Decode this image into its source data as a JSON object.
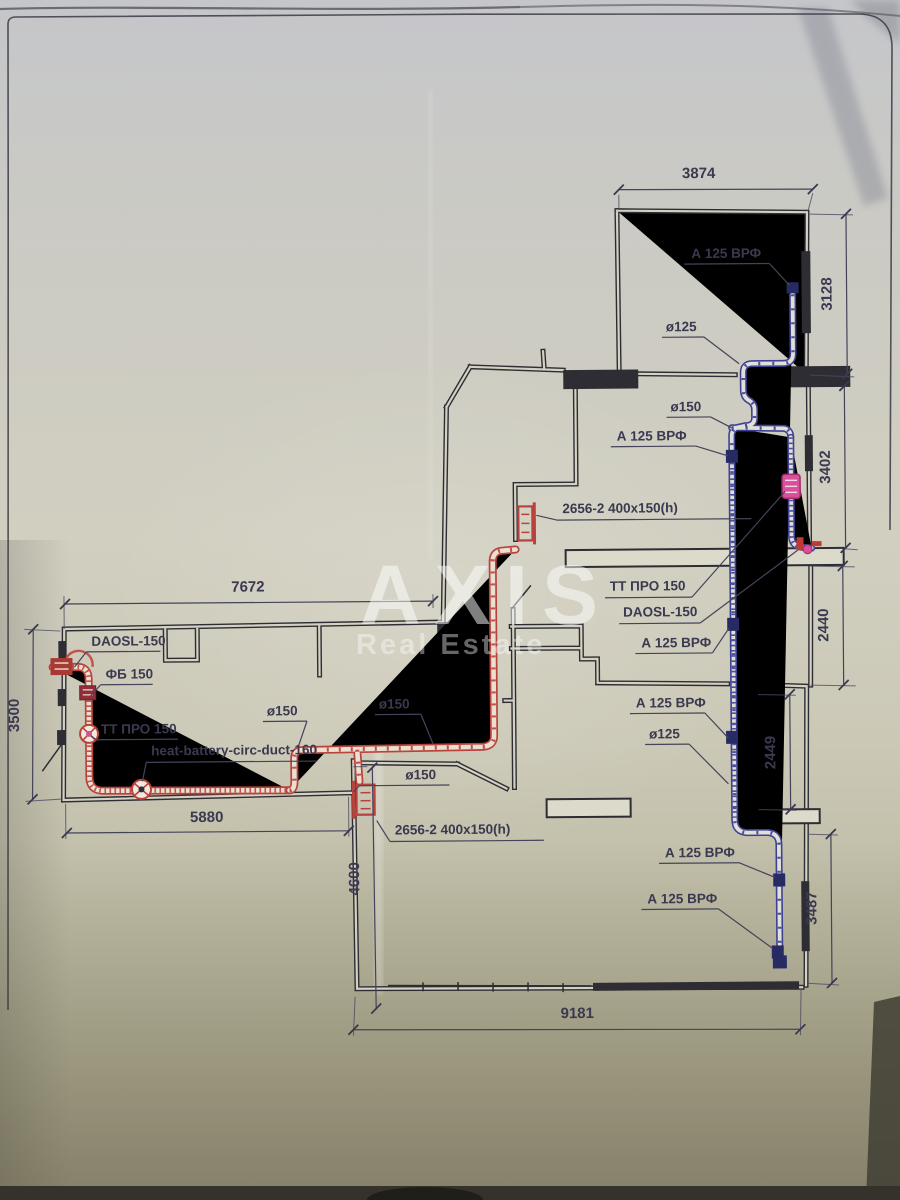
{
  "document": {
    "type": "scanned ventilation floor plan photo",
    "watermark": {
      "line1": "AXIS",
      "line2": "Real Estate"
    }
  },
  "colors": {
    "paper": "#d1cfc0",
    "ink": "#2e2d33",
    "annotation": "#3b3950",
    "supply_duct_red": "#b8433c",
    "exhaust_duct_blue": "#3d4293",
    "fitting_pink": "#d0548f",
    "grille_navy": "#272b63"
  },
  "plan": {
    "dimensions": [
      {
        "id": "dim-3874",
        "value": "3874",
        "x1": 622,
        "y1": 191,
        "x2": 816,
        "y2": 192,
        "tx": 702,
        "ty": 180,
        "rot": 0
      },
      {
        "id": "dim-3128",
        "value": "3128",
        "x1": 849,
        "y1": 217,
        "x2": 849,
        "y2": 377,
        "tx": 834,
        "ty": 297,
        "rot": -90
      },
      {
        "id": "dim-3402",
        "value": "3402",
        "x1": 846,
        "y1": 389,
        "x2": 846,
        "y2": 551,
        "tx": 831,
        "ty": 470,
        "rot": -90
      },
      {
        "id": "dim-2440",
        "value": "2440",
        "x1": 843,
        "y1": 569,
        "x2": 843,
        "y2": 688,
        "tx": 828,
        "ty": 628,
        "rot": -90
      },
      {
        "id": "dim-2449",
        "value": "2449",
        "x1": 789,
        "y1": 697,
        "x2": 789,
        "y2": 812,
        "tx": 774,
        "ty": 755,
        "rot": -90
      },
      {
        "id": "dim-3487",
        "value": "3487",
        "x1": 829,
        "y1": 837,
        "x2": 829,
        "y2": 986,
        "tx": 814,
        "ty": 911,
        "rot": -90
      },
      {
        "id": "dim-9181",
        "value": "9181",
        "x1": 350,
        "y1": 1029,
        "x2": 797,
        "y2": 1032,
        "tx": 574,
        "ty": 1019,
        "rot": 0
      },
      {
        "id": "dim-4600",
        "value": "4600",
        "x1": 371,
        "y1": 767,
        "x2": 373,
        "y2": 1008,
        "tx": 357,
        "ty": 878,
        "rot": -90
      },
      {
        "id": "dim-5880",
        "value": "5880",
        "x1": 65,
        "y1": 830,
        "x2": 347,
        "y2": 830,
        "tx": 205,
        "ty": 820,
        "rot": 0
      },
      {
        "id": "dim-7672",
        "value": "7672",
        "x1": 65,
        "y1": 601,
        "x2": 433,
        "y2": 601,
        "tx": 248,
        "ty": 590,
        "rot": 0
      },
      {
        "id": "dim-3500",
        "value": "3500",
        "x1": 33,
        "y1": 626,
        "x2": 31,
        "y2": 796,
        "tx": 18,
        "ty": 712,
        "rot": -90
      }
    ],
    "labels": [
      {
        "id": "grille-a125-1",
        "text": "А 125 ВРФ",
        "x": 694,
        "y": 260,
        "ul": [
          687,
          266,
          772,
          266
        ],
        "leader": [
          [
            772,
            266
          ],
          [
            792,
            288
          ]
        ]
      },
      {
        "id": "duct-o125-1",
        "text": "ø125",
        "x": 668,
        "y": 333,
        "ul": [
          664,
          339,
          706,
          339
        ],
        "leader": [
          [
            706,
            339
          ],
          [
            741,
            366
          ]
        ]
      },
      {
        "id": "duct-o150-1",
        "text": "ø150",
        "x": 672,
        "y": 413,
        "ul": [
          668,
          419,
          712,
          419
        ],
        "leader": [
          [
            712,
            419
          ],
          [
            733,
            430
          ]
        ]
      },
      {
        "id": "grille-a125-2",
        "text": "А 125 ВРФ",
        "x": 618,
        "y": 442,
        "ul": [
          612,
          448,
          697,
          448
        ],
        "leader": [
          [
            697,
            448
          ],
          [
            729,
            458
          ]
        ]
      },
      {
        "id": "grille-2656-top",
        "text": "2656-2 400x150(h)",
        "x": 563,
        "y": 514,
        "ul": [
          558,
          521,
          752,
          521
        ],
        "leader": [
          [
            558,
            521
          ],
          [
            537,
            516
          ]
        ]
      },
      {
        "id": "fitting-ttpro-right",
        "text": "ТТ ПРО 150",
        "x": 610,
        "y": 592,
        "ul": [
          605,
          599,
          692,
          599
        ],
        "leader": [
          [
            692,
            599
          ],
          [
            786,
            494
          ]
        ]
      },
      {
        "id": "fitting-daosl-right",
        "text": "DAOSL-150",
        "x": 623,
        "y": 618,
        "ul": [
          619,
          625,
          700,
          625
        ],
        "leader": [
          [
            700,
            625
          ],
          [
            798,
            553
          ]
        ]
      },
      {
        "id": "grille-a125-3",
        "text": "А 125 ВРФ",
        "x": 641,
        "y": 649,
        "ul": [
          635,
          655,
          712,
          655
        ],
        "leader": [
          [
            712,
            655
          ],
          [
            729,
            630
          ]
        ]
      },
      {
        "id": "grille-a125-4",
        "text": "А 125 ВРФ",
        "x": 635,
        "y": 709,
        "ul": [
          629,
          715,
          704,
          715
        ],
        "leader": [
          [
            704,
            715
          ],
          [
            727,
            740
          ]
        ]
      },
      {
        "id": "duct-o125-2",
        "text": "ø125",
        "x": 648,
        "y": 740,
        "ul": [
          644,
          746,
          688,
          746
        ],
        "leader": [
          [
            688,
            746
          ],
          [
            727,
            786
          ]
        ]
      },
      {
        "id": "grille-a125-5",
        "text": "А 125 ВРФ",
        "x": 663,
        "y": 859,
        "ul": [
          657,
          865,
          737,
          865
        ],
        "leader": [
          [
            737,
            865
          ],
          [
            773,
            880
          ]
        ]
      },
      {
        "id": "grille-a125-6",
        "text": "А 125 ВРФ",
        "x": 645,
        "y": 905,
        "ul": [
          639,
          911,
          716,
          911
        ],
        "leader": [
          [
            716,
            911
          ],
          [
            770,
            951
          ]
        ]
      },
      {
        "id": "grille-2656-bottom",
        "text": "2656-2 400x150(h)",
        "x": 393,
        "y": 834,
        "ul": [
          388,
          841,
          542,
          841
        ],
        "leader": [
          [
            388,
            841
          ],
          [
            375,
            820
          ]
        ]
      },
      {
        "id": "duct-o150-2",
        "text": "ø150",
        "x": 404,
        "y": 779,
        "ul": [
          358,
          785,
          448,
          785
        ],
        "leader": [
          [
            358,
            785
          ],
          [
            352,
            791
          ]
        ]
      },
      {
        "id": "duct-o150-3",
        "text": "ø150",
        "x": 378,
        "y": 708,
        "ul": [
          374,
          714,
          420,
          714
        ],
        "leader": [
          [
            420,
            714
          ],
          [
            432,
            744
          ]
        ]
      },
      {
        "id": "duct-o150-4",
        "text": "ø150",
        "x": 266,
        "y": 714,
        "ul": [
          262,
          720,
          306,
          720
        ],
        "leader": [
          [
            306,
            720
          ],
          [
            297,
            746
          ]
        ]
      },
      {
        "id": "fitting-ttpro-left",
        "text": "ТТ ПРО 150",
        "x": 100,
        "y": 731,
        "ul": [
          95,
          737,
          177,
          737
        ],
        "leader": [
          [
            95,
            737
          ],
          [
            90,
            733
          ]
        ]
      },
      {
        "id": "fitting-fb",
        "text": "ФБ 150",
        "x": 105,
        "y": 676,
        "ul": [
          100,
          682,
          152,
          682
        ],
        "leader": [
          [
            100,
            682
          ],
          [
            90,
            693
          ]
        ]
      },
      {
        "id": "fitting-daosl-left",
        "text": "DAOSL-150",
        "x": 91,
        "y": 643,
        "ul": [
          86,
          649,
          160,
          649
        ],
        "leader": [
          [
            86,
            649
          ],
          [
            74,
            664
          ]
        ]
      },
      {
        "id": "duct-heat-battery",
        "text": "heat-battery-circ-duct-160",
        "x": 150,
        "y": 753,
        "ul": [
          145,
          760,
          316,
          760
        ],
        "leader": [
          [
            145,
            760
          ],
          [
            141,
            779
          ]
        ]
      }
    ]
  }
}
